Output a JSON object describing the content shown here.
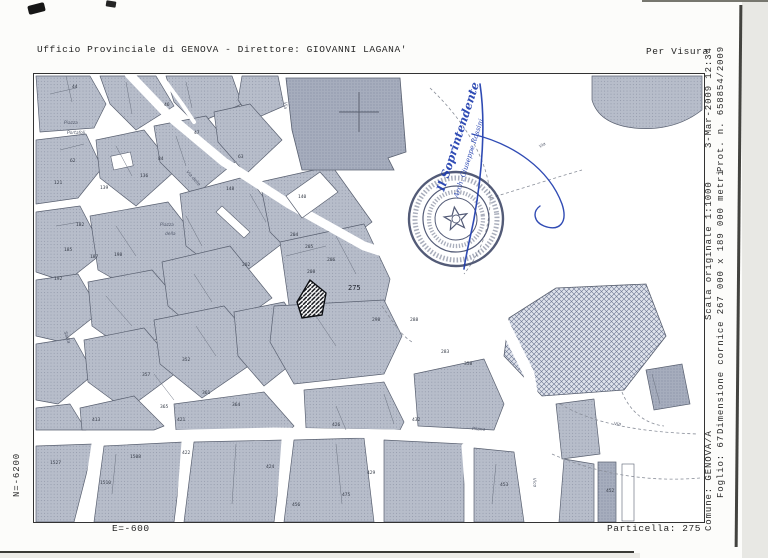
{
  "header": {
    "office_line": "Ufficio Provinciale di GENOVA - Direttore: GIOVANNI LAGANA'",
    "visura_label": "Per Visura"
  },
  "margin": {
    "datetime": "3-Mar-2009 12:34",
    "protocol": "Prot. n. 658854/2009",
    "scale": "Scala originale 1:1000",
    "frame_size": "Dimensione cornice 267 000 x 189 000 metri",
    "comune": "Comune: GENOVA/A",
    "foglio": "Foglio: 67",
    "particella": "Particella: 275",
    "coord_north": "N=-6200",
    "coord_east": "E=-600"
  },
  "stamp": {
    "signature_line1": "Il Soprintendente",
    "signature_line2": "Arch. Giuseppe Rossini",
    "ink_color": "#1e3cae",
    "seal_color": "#3c4565"
  },
  "map": {
    "subject_parcel": "275",
    "parcel_labels": [
      {
        "n": "44",
        "x": 38,
        "y": 14
      },
      {
        "n": "46",
        "x": 130,
        "y": 32
      },
      {
        "n": "47",
        "x": 160,
        "y": 60
      },
      {
        "n": "63",
        "x": 204,
        "y": 84
      },
      {
        "n": "84",
        "x": 124,
        "y": 86
      },
      {
        "n": "62",
        "x": 36,
        "y": 88
      },
      {
        "n": "121",
        "x": 20,
        "y": 110
      },
      {
        "n": "136",
        "x": 106,
        "y": 103
      },
      {
        "n": "139",
        "x": 66,
        "y": 115
      },
      {
        "n": "148",
        "x": 192,
        "y": 116
      },
      {
        "n": "140",
        "x": 264,
        "y": 124
      },
      {
        "n": "182",
        "x": 42,
        "y": 152
      },
      {
        "n": "185",
        "x": 30,
        "y": 177
      },
      {
        "n": "187",
        "x": 56,
        "y": 184
      },
      {
        "n": "198",
        "x": 80,
        "y": 182
      },
      {
        "n": "192",
        "x": 20,
        "y": 206
      },
      {
        "n": "202",
        "x": 208,
        "y": 192
      },
      {
        "n": "204",
        "x": 256,
        "y": 162
      },
      {
        "n": "205",
        "x": 271,
        "y": 174
      },
      {
        "n": "206",
        "x": 293,
        "y": 187
      },
      {
        "n": "208",
        "x": 273,
        "y": 199
      },
      {
        "n": "298",
        "x": 338,
        "y": 247
      },
      {
        "n": "288",
        "x": 376,
        "y": 247
      },
      {
        "n": "283",
        "x": 407,
        "y": 279
      },
      {
        "n": "358",
        "x": 430,
        "y": 291
      },
      {
        "n": "352",
        "x": 148,
        "y": 287
      },
      {
        "n": "357",
        "x": 108,
        "y": 302
      },
      {
        "n": "361",
        "x": 168,
        "y": 320
      },
      {
        "n": "364",
        "x": 198,
        "y": 332
      },
      {
        "n": "365",
        "x": 126,
        "y": 334
      },
      {
        "n": "421",
        "x": 143,
        "y": 347
      },
      {
        "n": "413",
        "x": 58,
        "y": 347
      },
      {
        "n": "1508",
        "x": 96,
        "y": 384
      },
      {
        "n": "1527",
        "x": 16,
        "y": 390
      },
      {
        "n": "1510",
        "x": 66,
        "y": 410
      },
      {
        "n": "422",
        "x": 148,
        "y": 380
      },
      {
        "n": "424",
        "x": 232,
        "y": 394
      },
      {
        "n": "426",
        "x": 298,
        "y": 352
      },
      {
        "n": "429",
        "x": 333,
        "y": 400
      },
      {
        "n": "475",
        "x": 308,
        "y": 422
      },
      {
        "n": "456",
        "x": 258,
        "y": 432
      },
      {
        "n": "432",
        "x": 378,
        "y": 347
      },
      {
        "n": "452",
        "x": 572,
        "y": 418
      },
      {
        "n": "453",
        "x": 466,
        "y": 412
      }
    ],
    "street_labels": [
      {
        "t": "Piazza",
        "x": 30,
        "y": 50,
        "r": 0
      },
      {
        "t": "Portafoli",
        "x": 33,
        "y": 60,
        "r": 0
      },
      {
        "t": "Via",
        "x": 250,
        "y": 28,
        "r": 90
      },
      {
        "t": "Via delle",
        "x": 152,
        "y": 98,
        "r": 48
      },
      {
        "t": "Piazza",
        "x": 126,
        "y": 152,
        "r": 0
      },
      {
        "t": "della",
        "x": 131,
        "y": 161,
        "r": 0
      },
      {
        "t": "Via",
        "x": 506,
        "y": 74,
        "r": -30
      },
      {
        "t": "Salita",
        "x": 30,
        "y": 258,
        "r": 72
      },
      {
        "t": "Pilana",
        "x": 438,
        "y": 356,
        "r": 3
      },
      {
        "t": "Via",
        "x": 580,
        "y": 351,
        "r": 3
      },
      {
        "t": "Vico",
        "x": 499,
        "y": 404,
        "r": 86
      }
    ]
  },
  "colors": {
    "block": "#b7bdca",
    "block_dark": "#a6adbd",
    "street": "#ffffff",
    "line": "#5d6470",
    "paper": "#fcfcfa"
  }
}
